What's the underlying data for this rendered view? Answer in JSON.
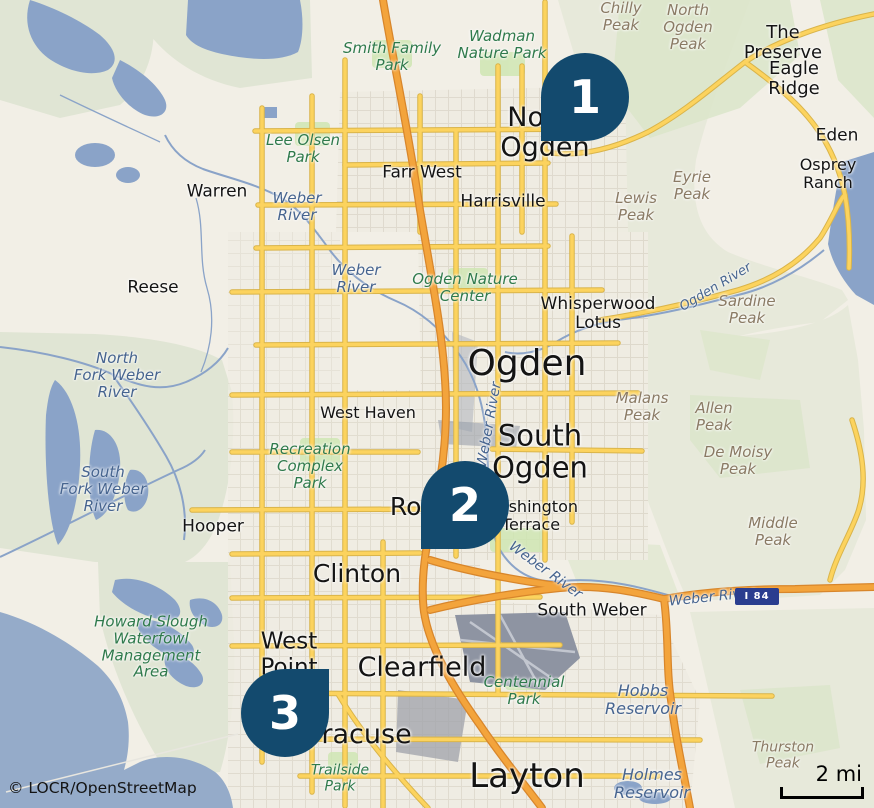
{
  "attribution": "© LOCR/OpenStreetMap",
  "scale": {
    "label": "2 mi"
  },
  "shield": {
    "label": "I 84"
  },
  "markers": [
    {
      "number": "1"
    },
    {
      "number": "2"
    },
    {
      "number": "3"
    }
  ],
  "colors": {
    "marker_pin": "#134a6e",
    "land": "#f2efe6",
    "mountain": "#e7e9da",
    "forest": "#dbe5c9",
    "water": "#8aa3c8",
    "road_primary": "#fcd35e",
    "road_motorway": "#f3a43c",
    "shield_bg": "#2a3d8f",
    "park_label": "#2f7a4c",
    "water_label": "#46648f",
    "peak_label": "#8a7a64"
  },
  "labels": {
    "cities": [
      "North\nOgden",
      "Ogden",
      "South\nOgden",
      "Layton",
      "Clearfield",
      "Clinton",
      "Syracuse",
      "Roy",
      "West\nPoint",
      "Hooper",
      "Warren",
      "Reese",
      "Farr West",
      "Harrisville",
      "West Haven",
      "Washington\nTerrace",
      "Whisperwood\nLotus",
      "South Weber",
      "The Preserve",
      "Eagle Ridge",
      "Eden",
      "Osprey\nRanch"
    ],
    "parks": [
      "Smith Family\nPark",
      "Wadman\nNature Park",
      "Lee Olsen\nPark",
      "Ogden Nature\nCenter",
      "Recreation\nComplex\nPark",
      "Centennial\nPark",
      "Trailside\nPark",
      "Howard Slough\nWaterfowl\nManagement\nArea"
    ],
    "water": [
      "Weber\nRiver",
      "Weber\nRiver",
      "North\nFork Weber\nRiver",
      "South\nFork Weber\nRiver",
      "Weber River",
      "Weber River",
      "Weber River",
      "Ogden River",
      "Hobbs\nReservoir",
      "Holmes\nReservoir"
    ],
    "peaks": [
      "Chilly\nPeak",
      "North\nOgden\nPeak",
      "Eyrie\nPeak",
      "Lewis\nPeak",
      "Sardine\nPeak",
      "Malans\nPeak",
      "Allen\nPeak",
      "De Moisy\nPeak",
      "Middle\nPeak",
      "Thurston\nPeak"
    ]
  }
}
